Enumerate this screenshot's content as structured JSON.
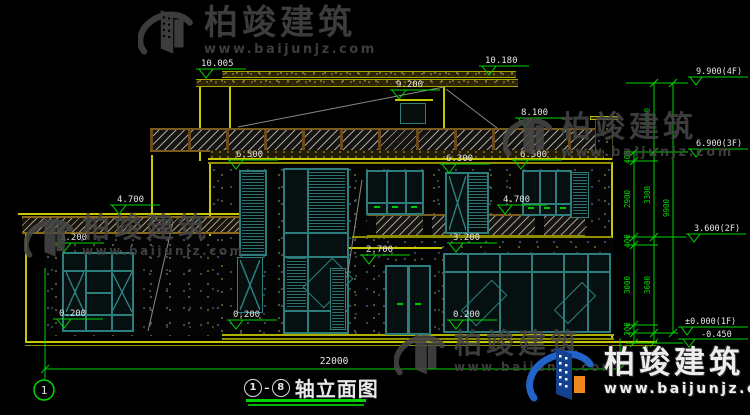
{
  "brand": {
    "name": "柏竣建筑",
    "url": "www.baijunjz.com"
  },
  "drawing_title": {
    "axis_start": "1",
    "separator": "-",
    "axis_end": "8",
    "name": "轴立面图"
  },
  "axis_bubble_label": "1",
  "levels": {
    "v10005": "10.005",
    "v10180": "10.180",
    "v9200": "9.200",
    "v8100": "8.100",
    "v6500": "6.500",
    "v6300": "6.300",
    "v4700": "4.700",
    "v3200": "3.200",
    "v2700": "2.700",
    "v0200": "0.200"
  },
  "floor_levels": {
    "f4": "9.900(4F)",
    "f3": "6.900(3F)",
    "f2": "3.600(2F)",
    "f1": "±0.000(1F)",
    "below_grade": "-0.450"
  },
  "dimensions": {
    "total_width": "22000",
    "total_height": "9900",
    "seg_3000": "3000",
    "seg_3300": "3300",
    "seg_3600": "3600",
    "seg_2900": "2900",
    "seg_400": "400",
    "seg_200": "200",
    "seg_450": "450"
  },
  "colors": {
    "background": "#000000",
    "cad_yellow": "#c8c800",
    "cad_green": "#00d400",
    "frame_teal": "#2e7d7d",
    "hatch_brown": "#7a5c1a",
    "text_white": "#e5e5e5",
    "watermark_gray": "#454545",
    "logo_blue": "#1c55b0",
    "logo_orange": "#ef8820"
  }
}
